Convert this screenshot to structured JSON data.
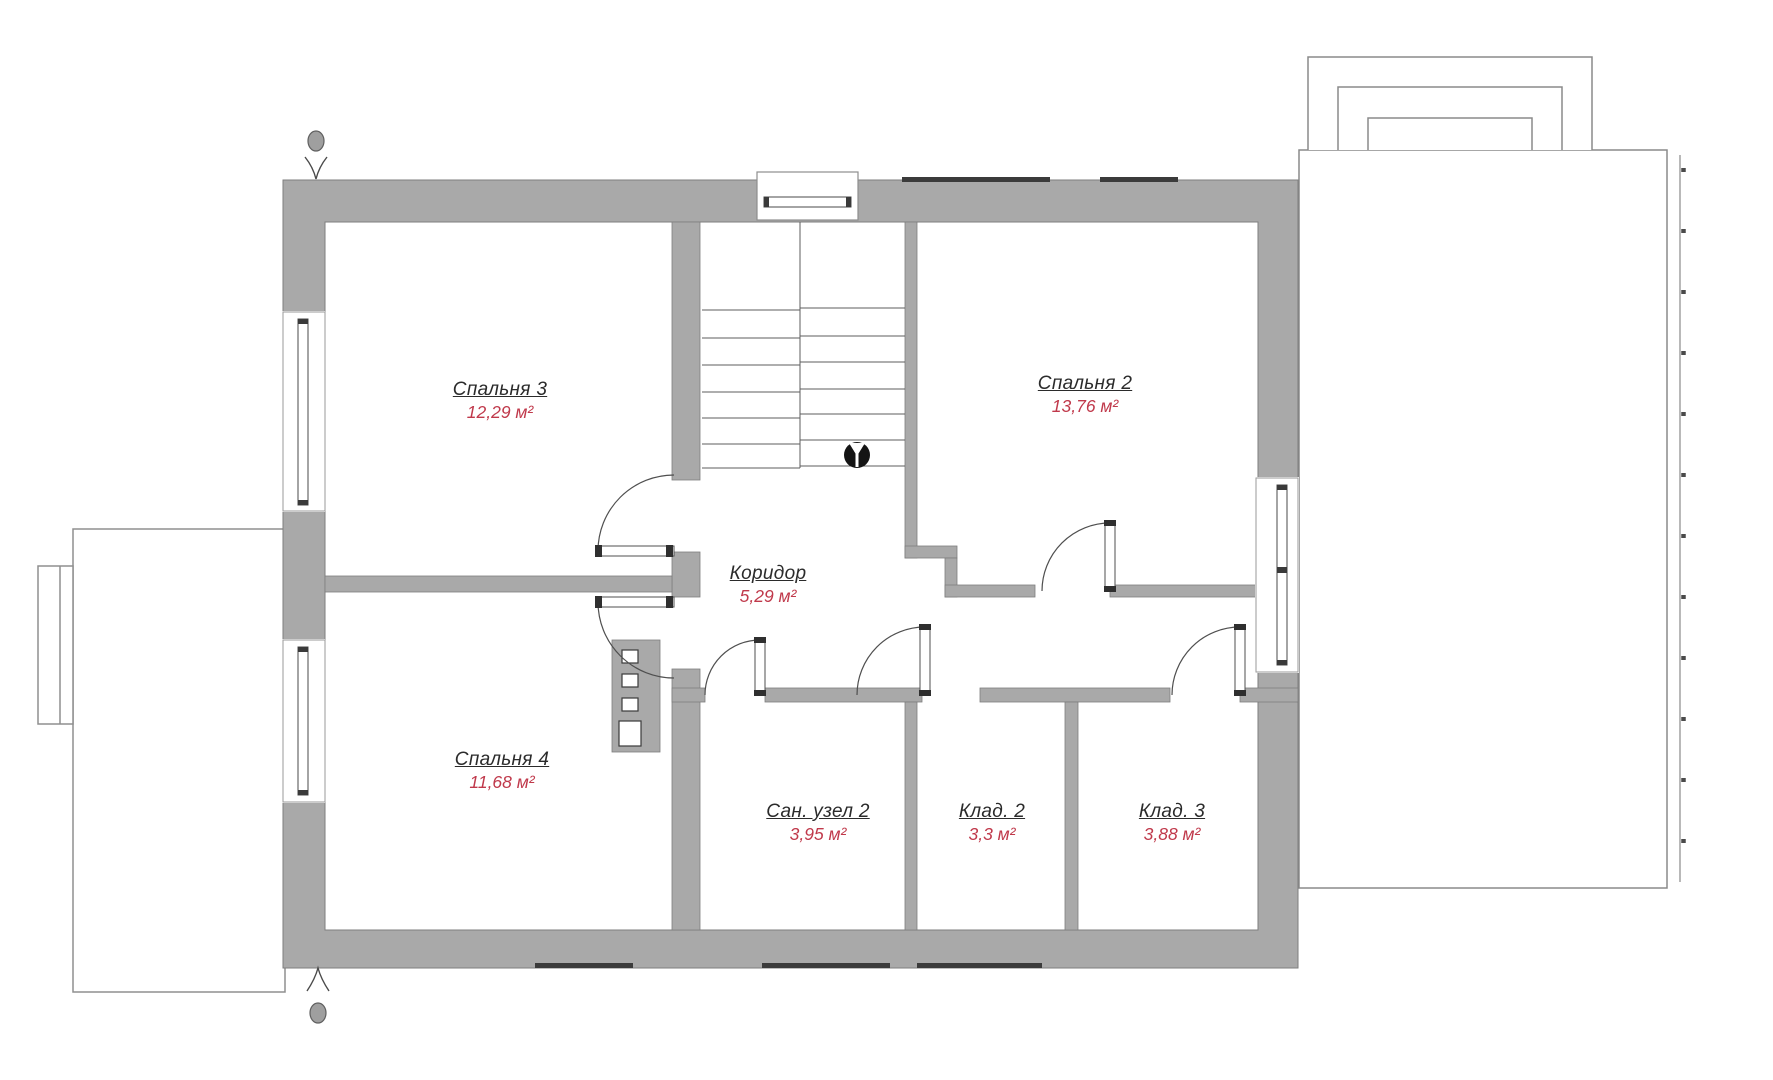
{
  "plan": {
    "floor_type": "floor-plan",
    "rooms": [
      {
        "id": "spalnya-3",
        "name": "Спальня 3",
        "area": "12,29 м²"
      },
      {
        "id": "spalnya-2",
        "name": "Спальня 2",
        "area": "13,76 м²"
      },
      {
        "id": "koridor",
        "name": "Коридор",
        "area": "5,29 м²"
      },
      {
        "id": "spalnya-4",
        "name": "Спальня 4",
        "area": "11,68 м²"
      },
      {
        "id": "san-uzel-2",
        "name": "Сан. узел 2",
        "area": "3,95 м²"
      },
      {
        "id": "klad-2",
        "name": "Клад. 2",
        "area": "3,3 м²"
      },
      {
        "id": "klad-3",
        "name": "Клад. 3",
        "area": "3,88 м²"
      }
    ],
    "colors": {
      "wall_fill": "#a9a9a9",
      "wall_outline": "#7e7e7e",
      "thin_line": "#4f4f4f",
      "room_name_text": "#2b2b2b",
      "room_area_text": "#c0394b",
      "stair_marker": "#141414",
      "facade_mark": "#3b3b3b",
      "background": "#ffffff"
    }
  }
}
